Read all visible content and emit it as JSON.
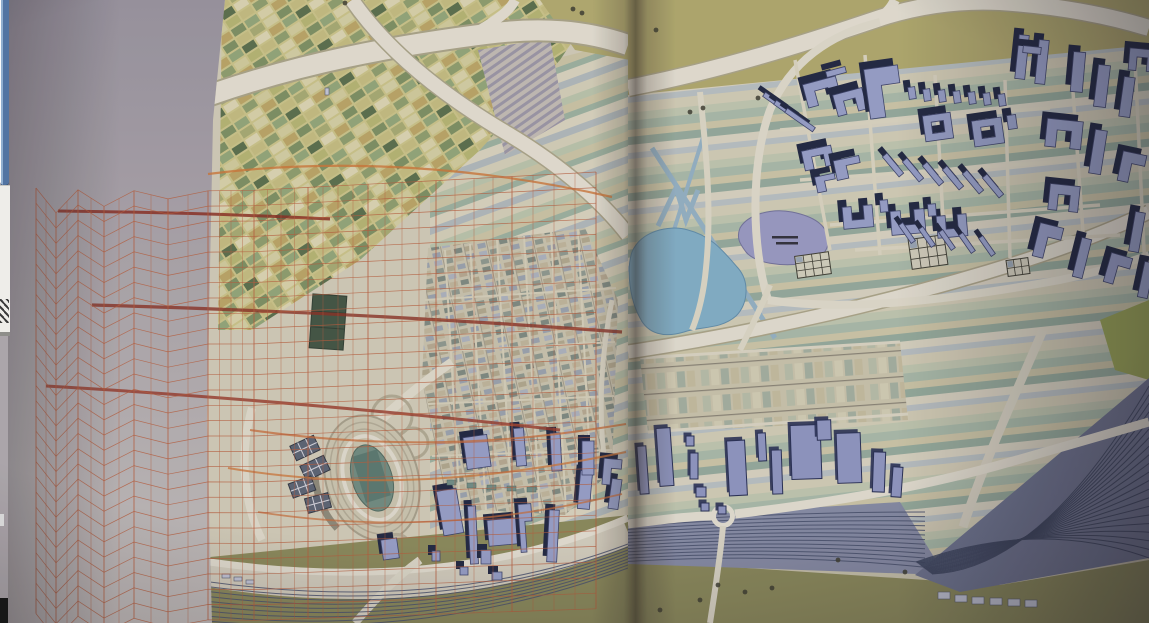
{
  "window": {
    "left_strip": {
      "scrollbar_fragment": "window-scrollbar-fragment",
      "panel_fragment": "window-panel-fragment",
      "zigzag_icon": "zigzag-chart-icon"
    }
  },
  "palette": {
    "pageL_top": "#9a94a0",
    "pageL_mid": "#b2acb0",
    "pageL_bot": "#c6c0bd",
    "pageR": "#cdc7ae",
    "mapBase": "#d5cfb8",
    "oliveTop": "#b3ab68",
    "road": "#e9e4d4",
    "roadCase": "#ada687",
    "lakeBlue": "#7fb2cc",
    "lakeBlueEdge": "#5d8fae",
    "lakePurple": "#9a9ac8",
    "lakePurpleEdge": "#71719e",
    "axonTop": "#97a1cd",
    "axonWall": "#1b2340",
    "axonStroke": "#39406b",
    "flatFill": "#8e96c5",
    "flatEdge": "#232c54",
    "railBand": "#868ca8",
    "railLine": "#46506e",
    "fanBase": "#6d7492",
    "oliveGround": "#8b8a55",
    "oliveDark": "#72713f",
    "lawn": "#9aa84e",
    "meshLine": "#bf5a35",
    "canal": "#93b4c8",
    "stadiumField": "#6e8d80",
    "trackRing": "#b5ae96",
    "waffle": "#5a6274",
    "greenBldg": "#3e5340",
    "gardenLine": "#3c3c30",
    "scrollBlue": "#4f74a6",
    "scrollBlueHi": "#8fb0d4",
    "panelWhite": "#f1f0ec",
    "darkCorner": "#141414"
  },
  "scene": {
    "mesh": {
      "columns": [
        36,
        56,
        78,
        104,
        134,
        168,
        208,
        254,
        308,
        368,
        436,
        512,
        596
      ],
      "rows": 29,
      "y_left": 202,
      "dy_left": 15.2,
      "y_right": 172,
      "dy_right": 15.6,
      "amp": 14,
      "amp_falloff": 7,
      "line_width": 0.7,
      "line_opacity": 0.8,
      "vert_width": 0.55,
      "vert_opacity": 0.7
    },
    "streaks": [
      {
        "d": "M58,211 C150,212 250,215 330,219",
        "w": 3,
        "c": "#8f2a1c",
        "o": 0.85
      },
      {
        "d": "M92,305 C280,310 460,320 622,332",
        "w": 3.2,
        "c": "#8f2a1c",
        "o": 0.8
      },
      {
        "d": "M46,386 C220,396 420,414 560,430",
        "w": 3,
        "c": "#9c3220",
        "o": 0.8
      },
      {
        "d": "M208,174 C340,157 480,167 612,197",
        "w": 2.2,
        "c": "#d4742f",
        "o": 0.8
      },
      {
        "d": "M250,430 C420,454 540,438 626,424",
        "w": 2,
        "c": "#cf6a30",
        "o": 0.75
      },
      {
        "d": "M228,468 C380,494 520,474 626,452",
        "w": 2,
        "c": "#d4742f",
        "o": 0.75
      },
      {
        "d": "M258,512 C400,534 520,518 622,494",
        "w": 1.8,
        "c": "#cf6a30",
        "o": 0.7
      }
    ],
    "axon_right": [
      {
        "t": "bar",
        "x": 778,
        "y": 104,
        "w": 5,
        "h": 34,
        "r": -55
      },
      {
        "t": "bar",
        "x": 789,
        "y": 112,
        "w": 5,
        "h": 34,
        "r": -55
      },
      {
        "t": "bar",
        "x": 800,
        "y": 120,
        "w": 5,
        "h": 34,
        "r": -55
      },
      {
        "t": "U",
        "x": 822,
        "y": 92,
        "w": 34,
        "h": 24,
        "r": -15
      },
      {
        "t": "U",
        "x": 850,
        "y": 102,
        "w": 30,
        "h": 22,
        "r": -15
      },
      {
        "t": "bar",
        "x": 836,
        "y": 72,
        "w": 20,
        "h": 6,
        "r": -15
      },
      {
        "t": "L",
        "x": 884,
        "y": 92,
        "w": 34,
        "h": 50,
        "r": -8
      },
      {
        "t": "bar",
        "x": 912,
        "y": 93,
        "w": 7,
        "h": 12,
        "r": -8
      },
      {
        "t": "bar",
        "x": 927,
        "y": 95,
        "w": 7,
        "h": 12,
        "r": -8
      },
      {
        "t": "bar",
        "x": 942,
        "y": 96,
        "w": 7,
        "h": 12,
        "r": -8
      },
      {
        "t": "bar",
        "x": 957,
        "y": 97,
        "w": 7,
        "h": 12,
        "r": -8
      },
      {
        "t": "bar",
        "x": 972,
        "y": 98,
        "w": 7,
        "h": 12,
        "r": -8
      },
      {
        "t": "bar",
        "x": 987,
        "y": 99,
        "w": 7,
        "h": 12,
        "r": -8
      },
      {
        "t": "bar",
        "x": 1002,
        "y": 100,
        "w": 7,
        "h": 12,
        "r": -8
      },
      {
        "t": "bar",
        "x": 1022,
        "y": 57,
        "w": 10,
        "h": 44,
        "r": 6
      },
      {
        "t": "bar",
        "x": 1042,
        "y": 62,
        "w": 10,
        "h": 44,
        "r": 6
      },
      {
        "t": "bar",
        "x": 1032,
        "y": 50,
        "w": 18,
        "h": 7,
        "r": 6
      },
      {
        "t": "bar",
        "x": 1078,
        "y": 72,
        "w": 12,
        "h": 40,
        "r": 5
      },
      {
        "t": "bar",
        "x": 1102,
        "y": 86,
        "w": 12,
        "h": 42,
        "r": 7
      },
      {
        "t": "bar",
        "x": 1127,
        "y": 97,
        "w": 11,
        "h": 40,
        "r": 8
      },
      {
        "t": "U",
        "x": 1142,
        "y": 60,
        "w": 26,
        "h": 22,
        "r": 5
      },
      {
        "t": "O",
        "x": 938,
        "y": 127,
        "w": 28,
        "h": 26,
        "r": -8
      },
      {
        "t": "O",
        "x": 988,
        "y": 132,
        "w": 30,
        "h": 26,
        "r": -8
      },
      {
        "t": "bar",
        "x": 1012,
        "y": 122,
        "w": 9,
        "h": 14,
        "r": -8
      },
      {
        "t": "U",
        "x": 818,
        "y": 158,
        "w": 30,
        "h": 20,
        "r": -12
      },
      {
        "t": "L",
        "x": 848,
        "y": 168,
        "w": 26,
        "h": 20,
        "r": -12
      },
      {
        "t": "L",
        "x": 826,
        "y": 183,
        "w": 20,
        "h": 16,
        "r": -12
      },
      {
        "t": "bar",
        "x": 893,
        "y": 165,
        "w": 6,
        "h": 26,
        "r": -40
      },
      {
        "t": "bar",
        "x": 913,
        "y": 170,
        "w": 6,
        "h": 26,
        "r": -40
      },
      {
        "t": "bar",
        "x": 933,
        "y": 174,
        "w": 6,
        "h": 26,
        "r": -40
      },
      {
        "t": "bar",
        "x": 953,
        "y": 178,
        "w": 6,
        "h": 26,
        "r": -40
      },
      {
        "t": "bar",
        "x": 973,
        "y": 182,
        "w": 6,
        "h": 26,
        "r": -40
      },
      {
        "t": "bar",
        "x": 993,
        "y": 186,
        "w": 6,
        "h": 26,
        "r": -40
      },
      {
        "t": "U",
        "x": 1064,
        "y": 134,
        "w": 36,
        "h": 28,
        "r": 6
      },
      {
        "t": "bar",
        "x": 1098,
        "y": 152,
        "w": 12,
        "h": 44,
        "r": 9
      },
      {
        "t": "L",
        "x": 1132,
        "y": 168,
        "w": 24,
        "h": 30,
        "r": 12
      },
      {
        "t": "C",
        "x": 858,
        "y": 217,
        "w": 30,
        "h": 22,
        "r": -5
      },
      {
        "t": "C",
        "x": 908,
        "y": 222,
        "w": 34,
        "h": 24,
        "r": -5
      },
      {
        "t": "C",
        "x": 952,
        "y": 226,
        "w": 30,
        "h": 22,
        "r": -5
      },
      {
        "t": "bar",
        "x": 884,
        "y": 206,
        "w": 8,
        "h": 12,
        "r": -5
      },
      {
        "t": "bar",
        "x": 932,
        "y": 210,
        "w": 8,
        "h": 12,
        "r": -5
      },
      {
        "t": "bar",
        "x": 907,
        "y": 233,
        "w": 5,
        "h": 22,
        "r": -35
      },
      {
        "t": "bar",
        "x": 927,
        "y": 237,
        "w": 5,
        "h": 22,
        "r": -35
      },
      {
        "t": "bar",
        "x": 947,
        "y": 240,
        "w": 5,
        "h": 22,
        "r": -35
      },
      {
        "t": "bar",
        "x": 967,
        "y": 243,
        "w": 5,
        "h": 22,
        "r": -35
      },
      {
        "t": "bar",
        "x": 987,
        "y": 246,
        "w": 5,
        "h": 22,
        "r": -35
      },
      {
        "t": "L",
        "x": 1048,
        "y": 242,
        "w": 24,
        "h": 34,
        "r": 14
      },
      {
        "t": "bar",
        "x": 1082,
        "y": 258,
        "w": 10,
        "h": 40,
        "r": 14
      },
      {
        "t": "L",
        "x": 1118,
        "y": 270,
        "w": 22,
        "h": 30,
        "r": 16
      },
      {
        "t": "U",
        "x": 1064,
        "y": 198,
        "w": 30,
        "h": 26,
        "r": 6
      },
      {
        "t": "bar",
        "x": 1137,
        "y": 232,
        "w": 10,
        "h": 40,
        "r": 10
      },
      {
        "t": "bar",
        "x": 1146,
        "y": 280,
        "w": 10,
        "h": 36,
        "r": 12
      }
    ],
    "axon_left": [
      {
        "t": "bar",
        "x": 450,
        "y": 512,
        "w": 20,
        "h": 45,
        "r": -10
      },
      {
        "t": "bar",
        "x": 473,
        "y": 535,
        "w": 8,
        "h": 58,
        "r": -3
      },
      {
        "t": "bar",
        "x": 486,
        "y": 557,
        "w": 10,
        "h": 14,
        "r": 0
      },
      {
        "t": "bar",
        "x": 503,
        "y": 532,
        "w": 30,
        "h": 26,
        "r": -5
      },
      {
        "t": "L",
        "x": 526,
        "y": 528,
        "w": 13,
        "h": 48,
        "r": -4
      },
      {
        "t": "bar",
        "x": 553,
        "y": 536,
        "w": 10,
        "h": 52,
        "r": 3
      },
      {
        "t": "bar",
        "x": 585,
        "y": 490,
        "w": 12,
        "h": 38,
        "r": 5
      },
      {
        "t": "bar",
        "x": 615,
        "y": 494,
        "w": 10,
        "h": 30,
        "r": 8
      },
      {
        "t": "bar",
        "x": 390,
        "y": 549,
        "w": 16,
        "h": 20,
        "r": -8
      },
      {
        "t": "bar",
        "x": 436,
        "y": 556,
        "w": 8,
        "h": 10,
        "r": 0
      },
      {
        "t": "bar",
        "x": 464,
        "y": 571,
        "w": 8,
        "h": 8,
        "r": 0
      },
      {
        "t": "bar",
        "x": 497,
        "y": 576,
        "w": 10,
        "h": 8,
        "r": 0
      },
      {
        "t": "bar",
        "x": 477,
        "y": 452,
        "w": 24,
        "h": 32,
        "r": -8
      },
      {
        "t": "bar",
        "x": 520,
        "y": 447,
        "w": 10,
        "h": 38,
        "r": -5
      },
      {
        "t": "bar",
        "x": 556,
        "y": 452,
        "w": 10,
        "h": 38,
        "r": -3
      },
      {
        "t": "bar",
        "x": 588,
        "y": 458,
        "w": 12,
        "h": 34,
        "r": 0
      },
      {
        "t": "L",
        "x": 612,
        "y": 472,
        "w": 18,
        "h": 26,
        "r": 5
      }
    ],
    "flat_right": [
      {
        "x": 665,
        "y": 457,
        "w": 14,
        "h": 58,
        "r": -4
      },
      {
        "x": 643,
        "y": 470,
        "w": 9,
        "h": 48,
        "r": -4
      },
      {
        "x": 690,
        "y": 441,
        "w": 8,
        "h": 10,
        "r": 0
      },
      {
        "x": 694,
        "y": 466,
        "w": 8,
        "h": 26,
        "r": 0
      },
      {
        "x": 701,
        "y": 492,
        "w": 10,
        "h": 10,
        "r": 0
      },
      {
        "x": 737,
        "y": 468,
        "w": 18,
        "h": 55,
        "r": -3
      },
      {
        "x": 762,
        "y": 447,
        "w": 8,
        "h": 28,
        "r": -3
      },
      {
        "x": 777,
        "y": 472,
        "w": 10,
        "h": 44,
        "r": -2
      },
      {
        "x": 806,
        "y": 452,
        "w": 30,
        "h": 54,
        "r": -2
      },
      {
        "x": 824,
        "y": 430,
        "w": 14,
        "h": 20,
        "r": -2
      },
      {
        "x": 849,
        "y": 458,
        "w": 24,
        "h": 50,
        "r": -2
      },
      {
        "x": 879,
        "y": 472,
        "w": 12,
        "h": 40,
        "r": 2
      },
      {
        "x": 897,
        "y": 482,
        "w": 10,
        "h": 30,
        "r": 4
      },
      {
        "x": 705,
        "y": 507,
        "w": 8,
        "h": 8,
        "r": 0
      },
      {
        "x": 722,
        "y": 510,
        "w": 8,
        "h": 8,
        "r": 0
      }
    ],
    "teal_roofs": [
      [
        447,
        480
      ],
      [
        467,
        483
      ],
      [
        487,
        485
      ],
      [
        507,
        486
      ],
      [
        527,
        487
      ]
    ],
    "gardens": [
      {
        "x": 813,
        "y": 265,
        "w": 34,
        "h": 22,
        "r": -8,
        "cols": 4,
        "rows": 3
      },
      {
        "x": 928,
        "y": 252,
        "w": 36,
        "h": 30,
        "r": -8,
        "cols": 4,
        "rows": 3
      },
      {
        "x": 1018,
        "y": 267,
        "w": 22,
        "h": 16,
        "r": -8,
        "cols": 3,
        "rows": 2
      }
    ],
    "waffles": [
      {
        "x": 305,
        "y": 448,
        "w": 26,
        "h": 16,
        "r": -25
      },
      {
        "x": 315,
        "y": 468,
        "w": 26,
        "h": 16,
        "r": -25
      },
      {
        "x": 302,
        "y": 487,
        "w": 24,
        "h": 15,
        "r": -20
      },
      {
        "x": 318,
        "y": 503,
        "w": 24,
        "h": 15,
        "r": -15
      }
    ],
    "glyph_dark": [
      [
        573,
        9
      ],
      [
        582,
        13
      ],
      [
        656,
        30
      ],
      [
        703,
        108
      ],
      [
        345,
        3
      ],
      [
        758,
        98
      ],
      [
        690,
        112
      ],
      [
        838,
        560
      ],
      [
        718,
        585
      ],
      [
        745,
        592
      ],
      [
        772,
        588
      ],
      [
        700,
        600
      ],
      [
        660,
        610
      ],
      [
        905,
        572
      ]
    ],
    "glyph_pale": [
      [
        325,
        88,
        4,
        7
      ],
      [
        938,
        592,
        12,
        7
      ],
      [
        955,
        595,
        12,
        7
      ],
      [
        972,
        597,
        12,
        7
      ],
      [
        990,
        598,
        12,
        7
      ],
      [
        1008,
        599,
        12,
        7
      ],
      [
        1025,
        600,
        12,
        7
      ],
      [
        222,
        574,
        8,
        4
      ],
      [
        234,
        577,
        8,
        4
      ],
      [
        246,
        580,
        8,
        4
      ]
    ],
    "rails": {
      "left_count": 9,
      "right_count": 13,
      "fan_count": 21
    }
  }
}
